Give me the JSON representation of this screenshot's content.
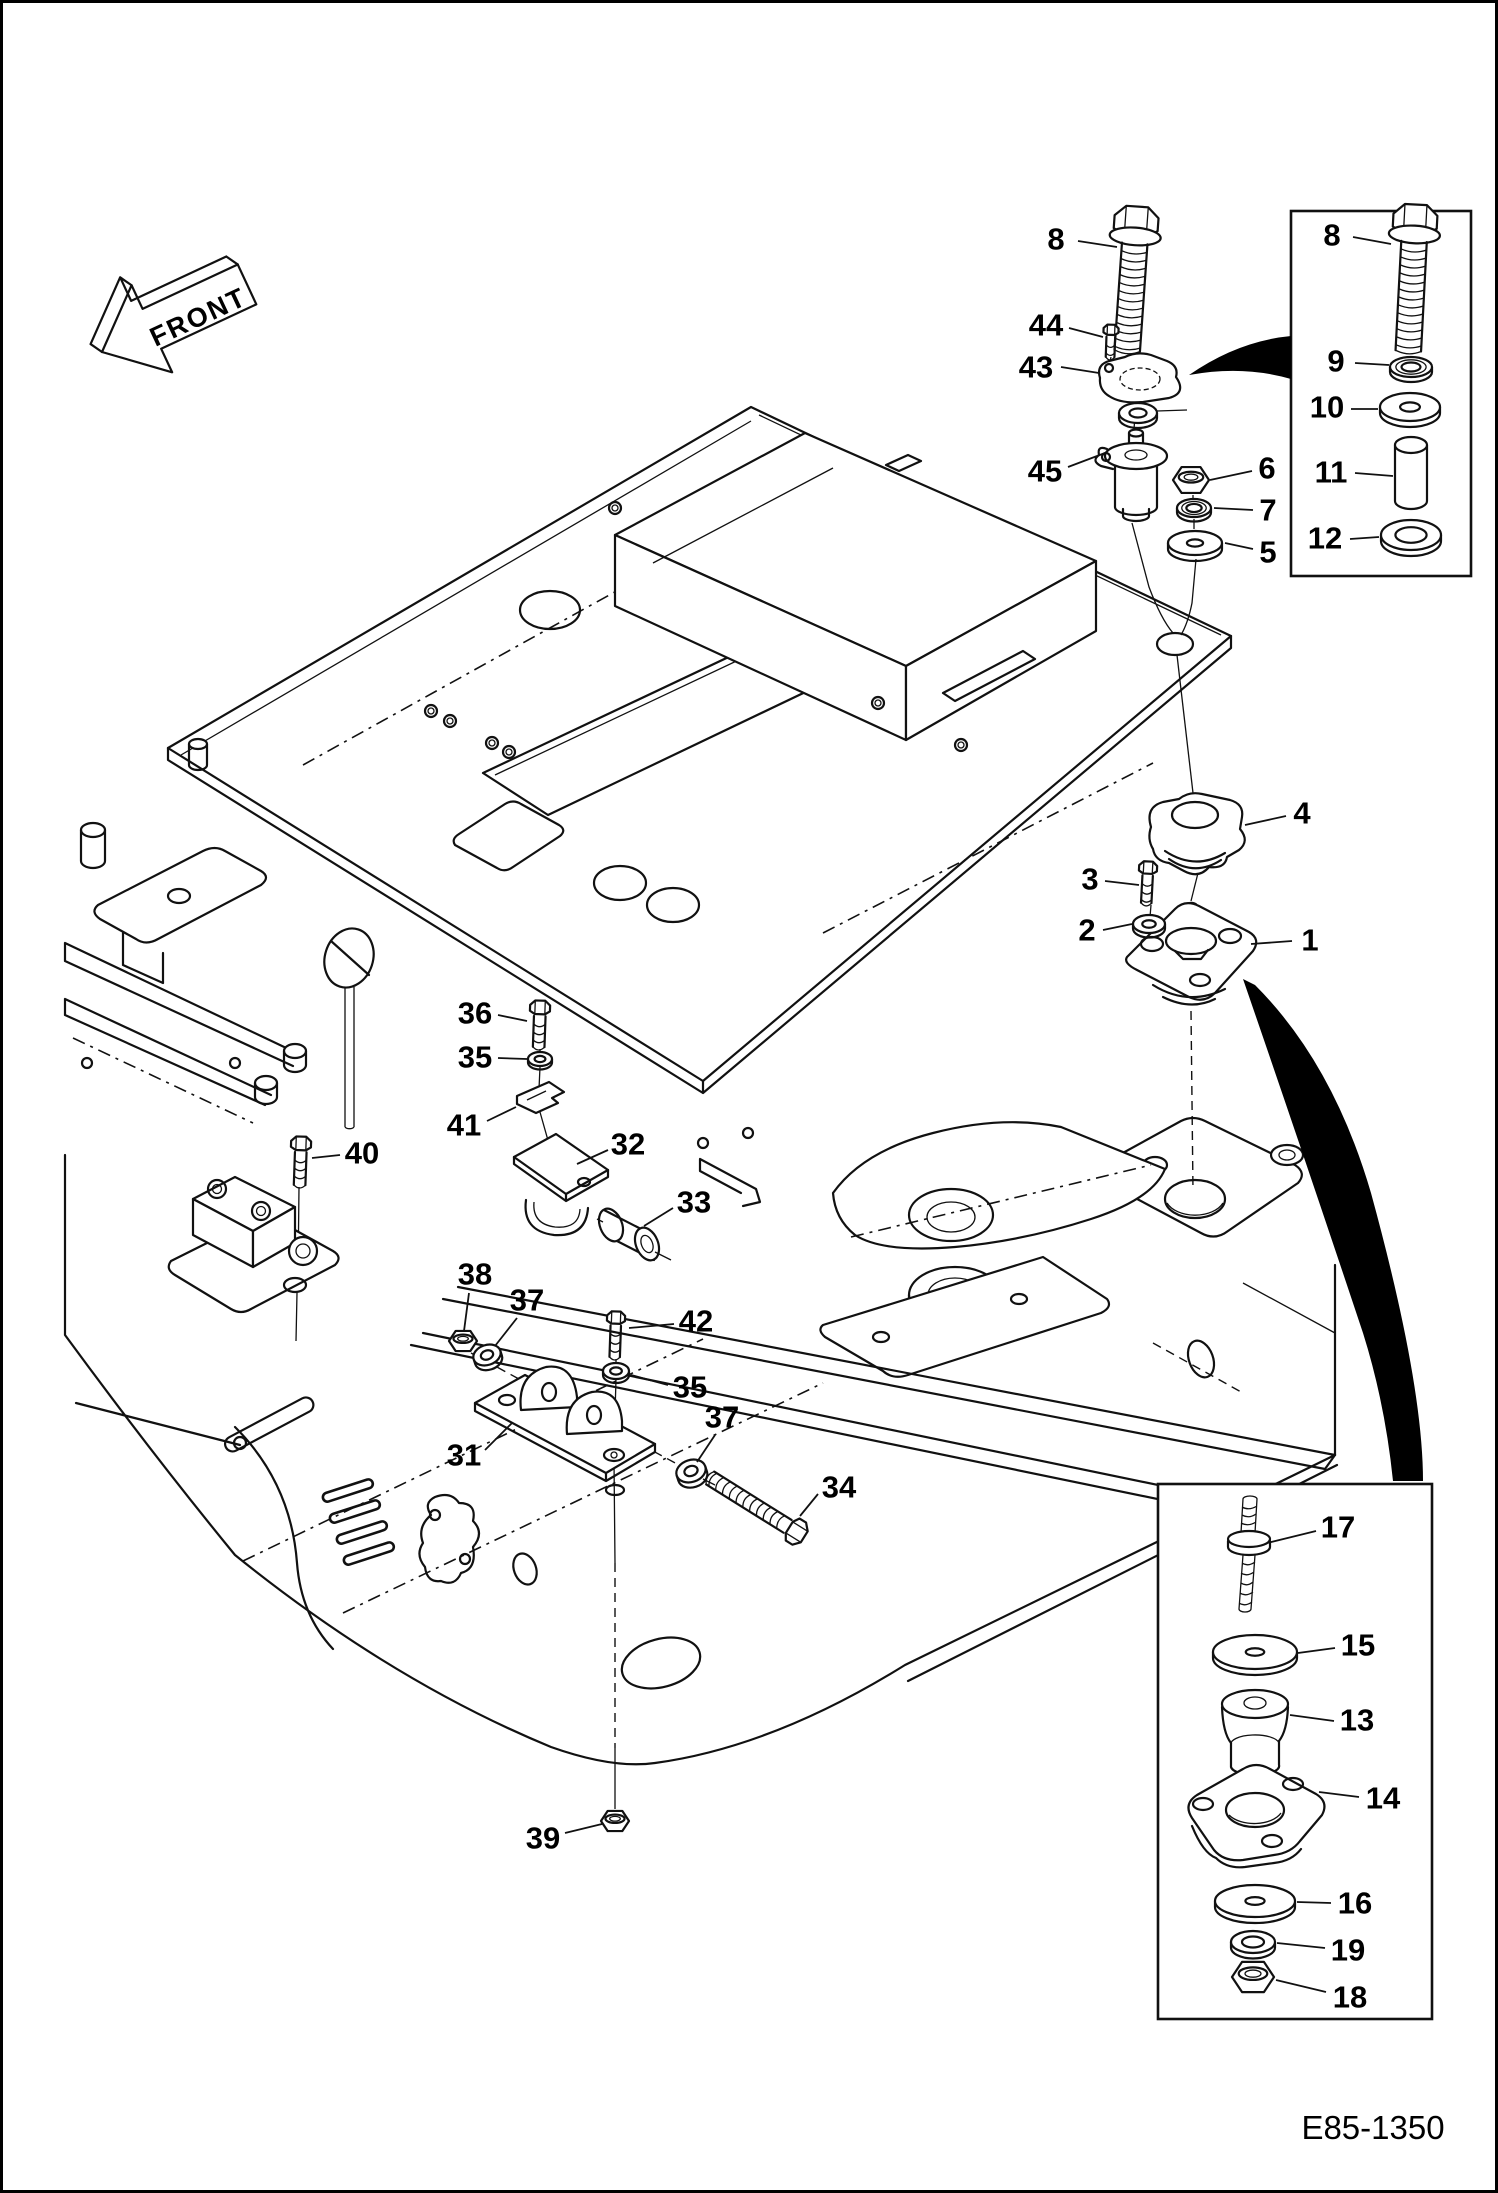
{
  "page": {
    "figure_code": "E85-1350",
    "front_label": "FRONT",
    "background": "#ffffff",
    "line_color": "#111111"
  },
  "insets": [
    {
      "name": "bolt-stack-detail",
      "x": 1288,
      "y": 208,
      "width": 180,
      "height": 365
    },
    {
      "name": "mount-stack-detail",
      "x": 1155,
      "y": 1481,
      "width": 274,
      "height": 535
    }
  ],
  "callouts": [
    {
      "label": "8",
      "x": 1053,
      "y": 236,
      "leader": [
        1075,
        238,
        1114,
        244
      ]
    },
    {
      "label": "44",
      "x": 1043,
      "y": 322,
      "leader": [
        1066,
        325,
        1100,
        334
      ]
    },
    {
      "label": "43",
      "x": 1033,
      "y": 364,
      "leader": [
        1058,
        364,
        1096,
        370
      ]
    },
    {
      "label": "45",
      "x": 1042,
      "y": 468,
      "leader": [
        1065,
        464,
        1102,
        450
      ]
    },
    {
      "label": "6",
      "x": 1264,
      "y": 465,
      "leader": [
        1249,
        468,
        1207,
        477
      ]
    },
    {
      "label": "7",
      "x": 1265,
      "y": 507,
      "leader": [
        1250,
        507,
        1211,
        505
      ]
    },
    {
      "label": "5",
      "x": 1265,
      "y": 549,
      "leader": [
        1250,
        546,
        1222,
        540
      ]
    },
    {
      "label": "4",
      "x": 1299,
      "y": 810,
      "leader": [
        1283,
        813,
        1242,
        822
      ]
    },
    {
      "label": "3",
      "x": 1087,
      "y": 876,
      "leader": [
        1102,
        878,
        1136,
        882
      ]
    },
    {
      "label": "2",
      "x": 1084,
      "y": 927,
      "leader": [
        1100,
        927,
        1129,
        921
      ]
    },
    {
      "label": "1",
      "x": 1307,
      "y": 937,
      "leader": [
        1289,
        938,
        1248,
        941
      ]
    },
    {
      "label": "36",
      "x": 472,
      "y": 1010,
      "leader": [
        495,
        1012,
        524,
        1018
      ]
    },
    {
      "label": "35",
      "x": 472,
      "y": 1054,
      "leader": [
        495,
        1055,
        524,
        1056
      ]
    },
    {
      "label": "41",
      "x": 461,
      "y": 1122,
      "leader": [
        484,
        1118,
        513,
        1104
      ]
    },
    {
      "label": "32",
      "x": 625,
      "y": 1141,
      "leader": [
        605,
        1147,
        574,
        1161
      ]
    },
    {
      "label": "33",
      "x": 691,
      "y": 1199,
      "leader": [
        670,
        1205,
        641,
        1223
      ]
    },
    {
      "label": "40",
      "x": 359,
      "y": 1150,
      "leader": [
        337,
        1152,
        309,
        1155
      ]
    },
    {
      "label": "38",
      "x": 472,
      "y": 1271,
      "leader": [
        466,
        1290,
        461,
        1328
      ]
    },
    {
      "label": "37",
      "x": 524,
      "y": 1297,
      "leader": [
        514,
        1315,
        492,
        1343
      ]
    },
    {
      "label": "42",
      "x": 693,
      "y": 1318,
      "leader": [
        671,
        1321,
        626,
        1325
      ]
    },
    {
      "label": "35",
      "x": 687,
      "y": 1384,
      "leader": [
        665,
        1382,
        628,
        1372
      ]
    },
    {
      "label": "37",
      "x": 719,
      "y": 1414,
      "leader": [
        712,
        1432,
        694,
        1459
      ]
    },
    {
      "label": "31",
      "x": 461,
      "y": 1452,
      "leader": [
        482,
        1447,
        509,
        1420
      ]
    },
    {
      "label": "34",
      "x": 836,
      "y": 1484,
      "leader": [
        815,
        1491,
        797,
        1513
      ]
    },
    {
      "label": "39",
      "x": 540,
      "y": 1835,
      "leader": [
        562,
        1830,
        599,
        1821
      ]
    },
    {
      "label": "17",
      "x": 1335,
      "y": 1524,
      "leader": [
        1313,
        1528,
        1264,
        1540
      ]
    },
    {
      "label": "15",
      "x": 1355,
      "y": 1642,
      "leader": [
        1332,
        1645,
        1295,
        1650
      ]
    },
    {
      "label": "13",
      "x": 1354,
      "y": 1717,
      "leader": [
        1331,
        1718,
        1287,
        1712
      ]
    },
    {
      "label": "14",
      "x": 1380,
      "y": 1795,
      "leader": [
        1356,
        1794,
        1316,
        1789
      ]
    },
    {
      "label": "16",
      "x": 1352,
      "y": 1900,
      "leader": [
        1328,
        1900,
        1294,
        1899
      ]
    },
    {
      "label": "19",
      "x": 1345,
      "y": 1947,
      "leader": [
        1322,
        1945,
        1274,
        1940
      ]
    },
    {
      "label": "18",
      "x": 1347,
      "y": 1994,
      "leader": [
        1323,
        1989,
        1273,
        1977
      ]
    },
    {
      "label": "8",
      "x": 1329,
      "y": 232,
      "leader": [
        1350,
        234,
        1388,
        241
      ]
    },
    {
      "label": "9",
      "x": 1333,
      "y": 358,
      "leader": [
        1352,
        360,
        1386,
        362
      ]
    },
    {
      "label": "10",
      "x": 1324,
      "y": 404,
      "leader": [
        1348,
        406,
        1375,
        406
      ]
    },
    {
      "label": "11",
      "x": 1328,
      "y": 469,
      "leader": [
        1352,
        470,
        1390,
        473
      ]
    },
    {
      "label": "12",
      "x": 1322,
      "y": 535,
      "leader": [
        1347,
        536,
        1376,
        534
      ]
    }
  ],
  "hardware": [
    {
      "type": "bolt",
      "name": "hex-bolt-8",
      "x": 1133,
      "y": 222,
      "w": 44,
      "len": 126,
      "ang": 4,
      "flange": true
    },
    {
      "type": "bolt",
      "name": "screw-44",
      "x": 1108,
      "y": 328,
      "w": 15,
      "len": 26,
      "ang": 2
    },
    {
      "type": "washer",
      "name": "washer-under-43",
      "x": 1135,
      "y": 410,
      "rx": 19,
      "ry": 10,
      "hole": 0.45
    },
    {
      "type": "nut",
      "name": "nut-6",
      "x": 1188,
      "y": 477,
      "w": 36
    },
    {
      "type": "lockwasher",
      "name": "lock-washer-7",
      "x": 1191,
      "y": 505,
      "rx": 17,
      "ry": 9,
      "hole": 0.45
    },
    {
      "type": "washer",
      "name": "washer-5",
      "x": 1192,
      "y": 540,
      "rx": 27,
      "ry": 12,
      "hole": 0.3
    },
    {
      "type": "bolt",
      "name": "screw-3",
      "x": 1145,
      "y": 866,
      "w": 18,
      "len": 34,
      "ang": 3
    },
    {
      "type": "washer",
      "name": "washer-2",
      "x": 1146,
      "y": 921,
      "rx": 16,
      "ry": 9,
      "hole": 0.42
    },
    {
      "type": "bolt",
      "name": "bolt-36",
      "x": 537,
      "y": 1006,
      "w": 20,
      "len": 38,
      "ang": 2
    },
    {
      "type": "washer",
      "name": "washer-35-upper",
      "x": 537,
      "y": 1056,
      "rx": 12,
      "ry": 7,
      "hole": 0.45
    },
    {
      "type": "nut",
      "name": "nut-38",
      "x": 460,
      "y": 1338,
      "w": 28
    },
    {
      "type": "washer",
      "name": "washer-37-upper",
      "x": 484,
      "y": 1352,
      "rx": 14,
      "ry": 10,
      "hole": 0.45,
      "ang": -18
    },
    {
      "type": "bolt",
      "name": "screw-42",
      "x": 613,
      "y": 1316,
      "w": 18,
      "len": 38,
      "ang": 2
    },
    {
      "type": "washer",
      "name": "washer-35-lower",
      "x": 613,
      "y": 1368,
      "rx": 13,
      "ry": 8,
      "hole": 0.45
    },
    {
      "type": "washer",
      "name": "washer-37-lower",
      "x": 688,
      "y": 1468,
      "rx": 15,
      "ry": 11,
      "hole": 0.45,
      "ang": -18
    },
    {
      "type": "bolt",
      "name": "bolt-34",
      "x": 792,
      "y": 1528,
      "w": 26,
      "len": 100,
      "ang": 122
    },
    {
      "type": "nut",
      "name": "nut-39",
      "x": 612,
      "y": 1818,
      "w": 28
    },
    {
      "type": "bolt",
      "name": "bolt-40",
      "x": 298,
      "y": 1142,
      "w": 20,
      "len": 40,
      "ang": 2
    },
    {
      "type": "bolt",
      "name": "hex-bolt-8-inset",
      "x": 1412,
      "y": 220,
      "w": 44,
      "len": 128,
      "ang": 3,
      "flange": true
    },
    {
      "type": "lockwasher",
      "name": "lock-washer-9",
      "x": 1408,
      "y": 364,
      "rx": 21,
      "ry": 10,
      "hole": 0.45
    },
    {
      "type": "washer",
      "name": "washer-10",
      "x": 1407,
      "y": 404,
      "rx": 30,
      "ry": 14,
      "hole": 0.33,
      "t": 6
    },
    {
      "type": "cylinder",
      "name": "spacer-11",
      "x": 1408,
      "y": 442,
      "rx": 16,
      "ry": 8,
      "h": 56
    },
    {
      "type": "washer",
      "name": "washer-12",
      "x": 1408,
      "y": 532,
      "rx": 30,
      "ry": 15,
      "hole": 0.52,
      "t": 6
    },
    {
      "type": "washer",
      "name": "washer-15",
      "x": 1252,
      "y": 1649,
      "rx": 42,
      "ry": 17,
      "hole": 0.22,
      "t": 6
    },
    {
      "type": "washer",
      "name": "washer-16",
      "x": 1252,
      "y": 1898,
      "rx": 40,
      "ry": 16,
      "hole": 0.24,
      "t": 6
    },
    {
      "type": "washer",
      "name": "washer-19",
      "x": 1250,
      "y": 1939,
      "rx": 22,
      "ry": 11,
      "hole": 0.5
    },
    {
      "type": "nut",
      "name": "nut-18",
      "x": 1250,
      "y": 1974,
      "w": 42
    }
  ]
}
